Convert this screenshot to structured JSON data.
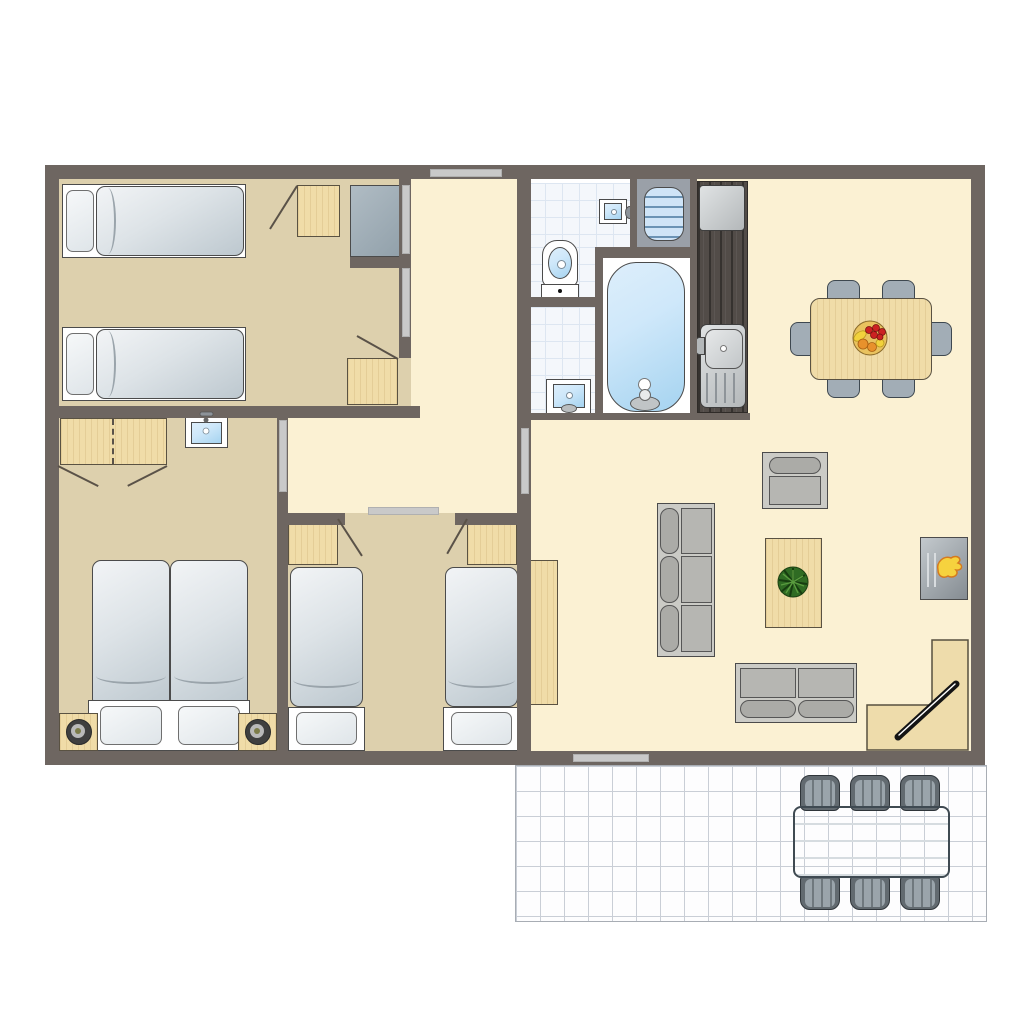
{
  "type": "floor-plan",
  "title": "Holiday cottage floor plan",
  "palette": {
    "wall": "#6e6661",
    "floorCream": "#fbf1d3",
    "floorTan": "#ddd0ad",
    "wood": "#f0dca8",
    "tile": "#f4f7fb",
    "tileLine": "#dde6f1",
    "cabinetGray": "#a3b1ba",
    "waterBlue": "#bfe0f6",
    "counterDark": "#524c48",
    "steel": "#c6cacc",
    "flameYellow": "#f6d23e",
    "flameOrange": "#d57a1f",
    "chairGray": "#a2adb6",
    "terraceLine": "#c9ced6",
    "doorBar": "#c9c9c9",
    "swing": "#5a5248"
  },
  "labels": {
    "plan": "Holiday cottage floor plan",
    "bedroom_top": "Bedroom with two single beds",
    "bedroom_middle": "Bedroom with two single beds",
    "bedroom_left": "Bedroom with double bed",
    "hallway": "Hallway",
    "toilet_room": "Toilet room",
    "shower_room": "Washbasin room",
    "bath_room": "Bathroom",
    "bathtub": "Bathtub",
    "toilet": "Toilet",
    "washbasin": "Washbasin",
    "hand_basin": "Hand basin",
    "radiator": "Radiator",
    "kitchen": "Kitchenette",
    "hob": "4-burner hob",
    "kitchen_sink": "Kitchen sink with drainer",
    "counter": "Kitchen counter",
    "living": "Living room with dining area",
    "dining_table": "Dining table for six",
    "dining_chair": "Dining chair",
    "fruit_bowl": "Fruit bowl",
    "sofa3": "Three-seat sofa",
    "sofa2": "Two-seat sofa",
    "armchair": "Armchair",
    "coffee_table": "Coffee table",
    "plant": "Plant",
    "fireplace": "Fireplace",
    "tv": "Television",
    "tv_unit": "Corner TV unit",
    "cabinet": "Cabinet",
    "bed_single": "Single bed",
    "bed_double": "Double bed",
    "wardrobe": "Wardrobe",
    "nightstand": "Bedside cabinet",
    "bedside_lamp": "Bedside table with lamp",
    "door_swing": "Door swing",
    "sliding_door": "Sliding door",
    "window": "Window",
    "terrace": "Tiled terrace",
    "terrace_table": "Outdoor dining table",
    "terrace_chair": "Outdoor chair"
  },
  "rooms": [
    {
      "name": "bedroom-top-left",
      "beds": 2
    },
    {
      "name": "bedroom-bottom-left",
      "beds": 1
    },
    {
      "name": "bedroom-middle",
      "beds": 2
    },
    {
      "name": "bathroom",
      "fixtures": [
        "toilet",
        "bathtub",
        "washbasin",
        "hand-basin",
        "radiator"
      ]
    },
    {
      "name": "kitchen",
      "fixtures": [
        "hob",
        "sink"
      ]
    },
    {
      "name": "living-dining",
      "furniture": [
        "dining-table",
        "6-chairs",
        "sofa-3",
        "sofa-2",
        "armchair",
        "coffee-table",
        "fireplace",
        "tv-corner-unit",
        "cabinet"
      ]
    },
    {
      "name": "terrace",
      "furniture": [
        "outdoor-table",
        "6-outdoor-chairs"
      ]
    }
  ]
}
